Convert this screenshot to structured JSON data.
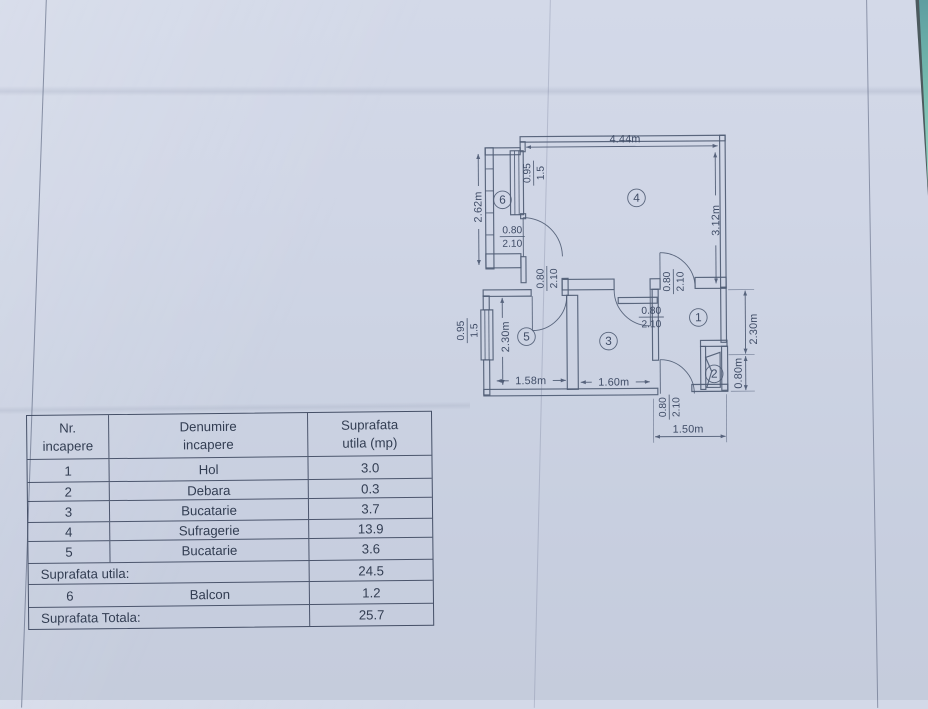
{
  "colors": {
    "paper": "#cdd4e3",
    "plan_ink": "#4b5872",
    "table_ink": "#333e52",
    "corner_teal": "#74b9ad"
  },
  "floor_plan": {
    "dim_top_width": "4.44m",
    "dim_livingroom_height": "3.12m",
    "dim_balcony_height": "2.62m",
    "dim_room5_height": "2.30m",
    "dim_room5_width": "1.58m",
    "dim_room3_width": "1.60m",
    "dim_hall_height": "2.30m",
    "dim_debara_height": "0.80m",
    "dim_bottom_right_width": "1.50m",
    "door_width": "0.80",
    "door_height": "2.10",
    "window_width": "0.95",
    "window_height": "1.5",
    "room_numbers": [
      "1",
      "2",
      "3",
      "4",
      "5",
      "6"
    ]
  },
  "table": {
    "columns": [
      {
        "line1": "Nr.",
        "line2": "incapere"
      },
      {
        "line1": "Denumire",
        "line2": "incapere"
      },
      {
        "line1": "Suprafata",
        "line2": "utila (mp)"
      }
    ],
    "rows": [
      [
        "1",
        "Hol",
        "3.0"
      ],
      [
        "2",
        "Debara",
        "0.3"
      ],
      [
        "3",
        "Bucatarie",
        "3.7"
      ],
      [
        "4",
        "Sufragerie",
        "13.9"
      ],
      [
        "5",
        "Bucatarie",
        "3.6"
      ]
    ],
    "summary": {
      "subtotal_label": "Suprafata utila:",
      "subtotal_value": "24.5",
      "balcony_nr": "6",
      "balcony_name": "Balcon",
      "balcony_value": "1.2",
      "total_label": "Suprafata Totala:",
      "total_value": "25.7"
    }
  }
}
